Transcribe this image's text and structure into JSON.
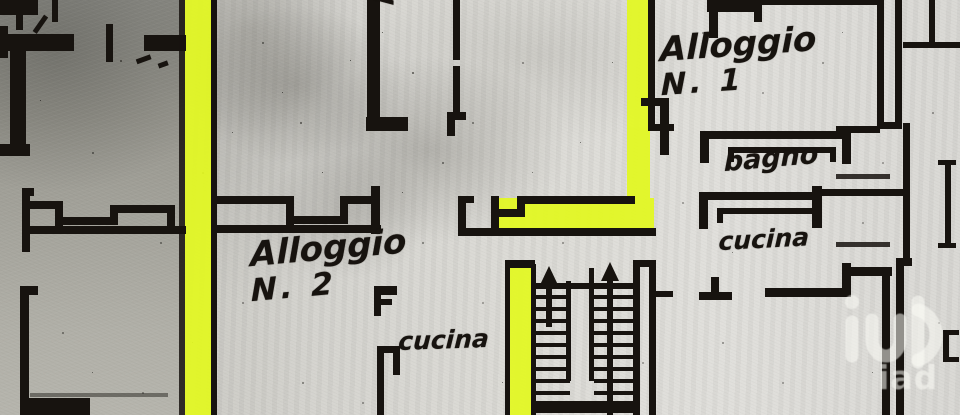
{
  "plan": {
    "apartment_1": {
      "line1": "Alloggio",
      "line2": "N. 1"
    },
    "apartment_2": {
      "line1": "Alloggio",
      "line2": "N. 2"
    },
    "rooms": {
      "bathroom_top": "bagno",
      "bathroom_right": "bagno",
      "kitchen_right": "cucina",
      "kitchen_center": "cucina"
    },
    "highlight_color": "#e3f91f",
    "ink_color": "#17130f"
  },
  "watermark": {
    "brand": "iad"
  }
}
